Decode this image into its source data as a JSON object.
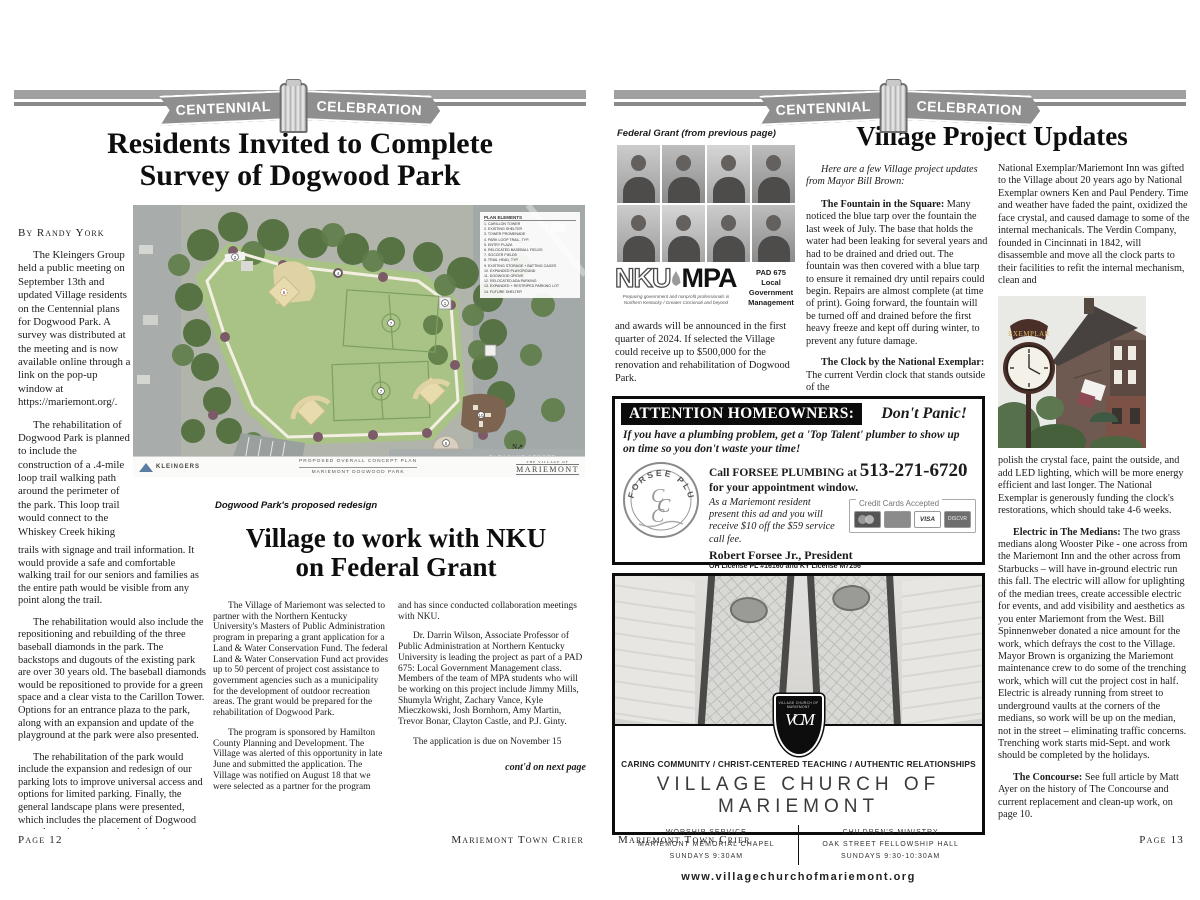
{
  "banner": {
    "left_word": "CENTENNIAL",
    "right_word": "CELEBRATION"
  },
  "left_page": {
    "headline_line1": "Residents Invited to Complete",
    "headline_line2": "Survey of Dogwood Park",
    "byline": "By Randy York",
    "intro_paras": [
      "The Kleingers Group held a public meeting on September 13th and updated Village residents on the Centennial plans for Dogwood Park. A survey was distributed at the meeting and is now available online through a link on the pop-up window at https://mariemont.org/.",
      "The rehabilitation of Dogwood Park is planned to include the construction of a .4-mile loop trail walking path around the perimeter of the park. This loop trail would connect to the Whiskey Creek hiking"
    ],
    "wide_continuation": "trails with signage and trail information. It would provide a safe and comfortable walking trail for our seniors and families as the entire path would be visible from any point along the trail.",
    "wide_paras": [
      "The rehabilitation would also include the repositioning and rebuilding of the three baseball diamonds in the park. The backstops and dugouts of the existing park are over 30 years old. The baseball diamonds would be repositioned to provide for a green space and a clear vista to the Carillon Tower. Options for an entrance plaza to the park, along with an expansion and update of the playground at the park were also presented.",
      "The rehabilitation of the park would include the expansion and redesign of our parking lots to improve universal access and options for limited parking. Finally, the general landscape plans were presented, which includes the placement of Dogwood trees throughout the park and the placement of benches along the trail."
    ],
    "map": {
      "legend_title": "PLAN ELEMENTS",
      "legend_items": [
        "1.  CARILLON TOWER",
        "2.  EXISTING SHELTER",
        "3.  TOWER PROMENADE",
        "4.  PARK LOOP TRAIL, TYP.",
        "5.  ENTRY PLAZA",
        "6.  RELOCATED BASEBALL FIELDS",
        "7.  SOCCER FIELDS",
        "8.  TRAIL HEAD, TYP.",
        "9.  EXISTING STORAGE + BATTING CAGES",
        "10. EXPANDED PLAYGROUND",
        "11. DOGWOOD GROVE",
        "12. RELOCATED ADA PARKING",
        "13. EXPANDED + RESTRIPED PARKING LOT",
        "14. FUTURE SHELTER"
      ],
      "plan_label_1": "PROPOSED OVERALL CONCEPT PLAN",
      "plan_label_2": "MARIEMONT DOGWOOD PARK",
      "firm_logo": "KLEINGERS",
      "village_logo_top": "THE VILLAGE OF",
      "village_logo": "MARIEMONT",
      "street_label": "PLEASANT STREET",
      "north_label": "N"
    },
    "map_caption": "Dogwood Park's proposed redesign",
    "grant_article": {
      "headline_line1": "Village to work with NKU",
      "headline_line2": "on Federal Grant",
      "col1_paras": [
        "The Village of Mariemont was selected to partner with the Northern Kentucky University's Masters of Public Administration program in preparing a grant application for a Land & Water Conservation Fund. The federal Land & Water Conservation Fund act provides up to 50 percent of project cost assistance to government agencies such as a municipality for the development of outdoor recreation areas. The grant would be prepared for the rehabilitation of Dogwood Park.",
        "The program is sponsored by Hamilton County Planning and Development. The Village was alerted of this opportunity in late June and submitted the application. The Village was notified on August 18 that we were selected as a partner for the program"
      ],
      "col2_continuation": "and has since conducted collaboration meetings with NKU.",
      "col2_paras": [
        "Dr. Darrin Wilson, Associate Professor of Public Administration at Northern Kentucky University is leading the project as part of a PAD 675: Local Government Management class. Members of the team of MPA students who will be working on this project include Jimmy Mills, Shumyla Wright, Zachary Vance, Kyle Mieczkowski, Josh Bornhorn, Amy Martin, Trevor Bonar, Clayton Castle, and P.J. Ginty.",
        "The application is due on November 15"
      ],
      "contd": "cont'd on next page"
    },
    "footer_left": "Page 12",
    "footer_right": "Mariemont Town Crier"
  },
  "right_page": {
    "fg_caption": "Federal Grant (from previous page)",
    "nku": {
      "name_left": "NKU",
      "name_right": "MPA",
      "tagline_1": "Preparing government and nonprofit professionals in",
      "tagline_2": "Northern Kentucky / Greater Cincinnati and beyond",
      "course_lines": [
        "PAD 675",
        "Local",
        "Government",
        "Management"
      ]
    },
    "fg_continuation": "and awards will be announced in the first quarter of 2024. If selected the Village could receive up to $500,000 for the renovation and rehabilitation of Dogwood Park.",
    "updates": {
      "headline": "Village Project Updates",
      "intro": "Here are a few Village project updates from Mayor Bill Brown:",
      "col1_paras": [
        {
          "lead": "The Fountain in the Square:",
          "text": "Many noticed the blue tarp over the fountain the last week of July. The base that holds the water had been leaking for several years and had to be drained and dried out. The fountain was then covered with a blue tarp to ensure it remained dry until repairs could begin. Repairs are almost complete (at time of print). Going forward, the fountain will be turned off and drained before the first heavy freeze and kept off during winter, to prevent any future damage."
        },
        {
          "lead": "The Clock by the National Exemplar:",
          "text": "The current Verdin clock that stands outside of the"
        }
      ],
      "col2_continuation": "National Exemplar/Mariemont Inn was gifted to the Village about 20 years ago by National Exemplar owners Ken and Paul Pendery. Time and weather have faded the paint, oxidized the face crystal, and caused damage to some of the internal mechanicals. The Verdin Company, founded in Cincinnati in 1842, will disassemble and move all the clock parts to their facilities to refit the internal mechanism, clean and",
      "col2_continuation2": "polish the crystal face, paint the outside, and add LED lighting, which will be more energy efficient and last longer. The National Exemplar is generously funding the clock's restorations, which should take 4-6 weeks.",
      "col2_paras": [
        {
          "lead": "Electric in The Medians:",
          "text": "The two grass medians along Wooster Pike - one across from the Mariemont Inn and the other across from Starbucks – will have in-ground electric run this fall. The electric will allow for uplighting of the median trees, create accessible electric for events, and add visibility and aesthetics as you enter Mariemont from the West. Bill Spinnenweber donated a nice amount for the work, which defrays the cost to the Village. Mayor Brown is organizing the Mariemont maintenance crew to do some of the trenching work, which will cut the project cost in half. Electric is already running from street to underground vaults at the corners of the medians, so work will be up on the median, not in the street – eliminating traffic concerns. Trenching work starts mid-Sept. and work should be completed by the holidays."
        },
        {
          "lead": "The Concourse:",
          "text": "See full article by Matt Ayer on the history of The Concourse and current replacement and clean-up work, on page 10."
        }
      ]
    },
    "exemplar_photo": {
      "sign_text": "EXEMPLAR"
    },
    "plumbing_ad": {
      "header": "ATTENTION HOMEOWNERS:",
      "header_right": "Don't Panic!",
      "pitch": "If you have a plumbing problem,  get a 'Top Talent' plumber to show up on time so you don't waste your time!",
      "logo_arc_text": "FORSEE PLUMBING",
      "call_pre": "Call FORSEE PLUMBING at",
      "phone": "513-271-6720",
      "call_line2": "for your appointment window.",
      "offer": "As a Mariemont resident present this ad and you will receive $10 off the $59 service call fee.",
      "president": "Robert Forsee Jr., President",
      "license": "OH License PL #16160 and KY License M7256",
      "cards_label": "Credit Cards Accepted",
      "visa_label": "VISA",
      "discover_label": "DISCVR"
    },
    "church_ad": {
      "crest_top": "VILLAGE CHURCH OF MARIEMONT",
      "crest_monogram": "VCM",
      "tagline": "CARING COMMUNITY / CHRIST-CENTERED TEACHING / AUTHENTIC RELATIONSHIPS",
      "name": "VILLAGE CHURCH OF MARIEMONT",
      "left_lines": [
        "WORSHIP SERVICE",
        "MARIEMONT MEMORIAL CHAPEL",
        "SUNDAYS 9:30AM"
      ],
      "right_lines": [
        "CHILDREN'S MINISTRY",
        "OAK STREET FELLOWSHIP HALL",
        "SUNDAYS 9:30-10:30AM"
      ],
      "website": "www.villagechurchofmariemont.org"
    },
    "footer_left": "Mariemont Town Crier",
    "footer_right": "Page 13"
  }
}
